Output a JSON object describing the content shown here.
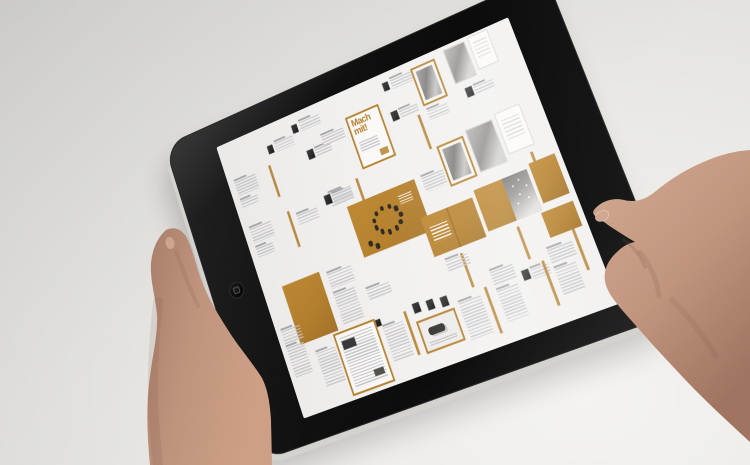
{
  "palette": {
    "background": "#e7e6e3",
    "bezel": "#141414",
    "edge": "#d3d2ce",
    "screen": "#f2f1ef",
    "accent": "#b5812e",
    "ink": "#c7c7ca",
    "thumb": "#2b2b2d",
    "skin": "#c59b85",
    "skin-shadow": "#9c7361",
    "nail": "#d0a892"
  },
  "device": {
    "home_button_glyph": "rounded-square"
  },
  "screen_content": {
    "cover_title": "Mach mit!",
    "tiles": [
      {
        "t": "tx",
        "x": 8,
        "y": 44,
        "w": 28,
        "h": 16
      },
      {
        "t": "tx",
        "x": 8,
        "y": 66,
        "w": 22,
        "h": 9
      },
      {
        "t": "ln",
        "x": 54,
        "y": 42,
        "w": 3,
        "h": 36
      },
      {
        "t": "th",
        "x": 60,
        "y": 22,
        "w": 7,
        "h": 9
      },
      {
        "t": "tx",
        "x": 70,
        "y": 22,
        "w": 24,
        "h": 10
      },
      {
        "t": "th",
        "x": 96,
        "y": 12,
        "w": 7,
        "h": 9
      },
      {
        "t": "tx",
        "x": 106,
        "y": 12,
        "w": 26,
        "h": 10
      },
      {
        "t": "th",
        "x": 104,
        "y": 44,
        "w": 8,
        "h": 10
      },
      {
        "t": "tx",
        "x": 114,
        "y": 46,
        "w": 20,
        "h": 8
      },
      {
        "t": "tx",
        "x": 126,
        "y": 36,
        "w": 28,
        "h": 12
      },
      {
        "t": "mm",
        "x": 160,
        "y": 28,
        "w": 42,
        "h": 58
      },
      {
        "t": "ln",
        "x": 148,
        "y": 92,
        "w": 3,
        "h": 36
      },
      {
        "t": "tx",
        "x": 112,
        "y": 96,
        "w": 28,
        "h": 14
      },
      {
        "t": "th",
        "x": 214,
        "y": 10,
        "w": 7,
        "h": 9
      },
      {
        "t": "tx",
        "x": 224,
        "y": 10,
        "w": 26,
        "h": 10
      },
      {
        "t": "th",
        "x": 212,
        "y": 42,
        "w": 8,
        "h": 10
      },
      {
        "t": "tx",
        "x": 222,
        "y": 44,
        "w": 22,
        "h": 8
      },
      {
        "t": "fp",
        "x": 250,
        "y": 8,
        "w": 30,
        "h": 42
      },
      {
        "t": "ln",
        "x": 240,
        "y": 56,
        "w": 3,
        "h": 38
      },
      {
        "t": "tx",
        "x": 252,
        "y": 56,
        "w": 24,
        "h": 10
      },
      {
        "t": "pp",
        "x": 292,
        "y": 4,
        "w": 26,
        "h": 38
      },
      {
        "t": "wp",
        "x": 322,
        "y": 2,
        "w": 24,
        "h": 36
      },
      {
        "t": "th",
        "x": 300,
        "y": 50,
        "w": 8,
        "h": 10
      },
      {
        "t": "tx",
        "x": 310,
        "y": 52,
        "w": 22,
        "h": 9
      },
      {
        "t": "tx",
        "x": 8,
        "y": 98,
        "w": 28,
        "h": 16
      },
      {
        "t": "tx",
        "x": 8,
        "y": 120,
        "w": 22,
        "h": 10
      },
      {
        "t": "ln",
        "x": 58,
        "y": 96,
        "w": 3,
        "h": 40
      },
      {
        "t": "tx",
        "x": 68,
        "y": 104,
        "w": 26,
        "h": 12
      },
      {
        "t": "th",
        "x": 106,
        "y": 96,
        "w": 8,
        "h": 10
      },
      {
        "t": "tx",
        "x": 116,
        "y": 98,
        "w": 24,
        "h": 10
      },
      {
        "t": "cp",
        "x": 128,
        "y": 116,
        "w": 84,
        "h": 56
      },
      {
        "t": "tx",
        "x": 220,
        "y": 118,
        "w": 26,
        "h": 16
      },
      {
        "t": "fp",
        "x": 248,
        "y": 94,
        "w": 32,
        "h": 44
      },
      {
        "t": "pp",
        "x": 284,
        "y": 90,
        "w": 32,
        "h": 46
      },
      {
        "t": "wp",
        "x": 320,
        "y": 86,
        "w": 30,
        "h": 44
      },
      {
        "t": "ln",
        "x": 342,
        "y": 136,
        "w": 3,
        "h": 36
      },
      {
        "t": "op",
        "x": 24,
        "y": 168,
        "w": 48,
        "h": 64
      },
      {
        "t": "tx",
        "x": 80,
        "y": 174,
        "w": 30,
        "h": 16
      },
      {
        "t": "tx",
        "x": 80,
        "y": 196,
        "w": 26,
        "h": 34
      },
      {
        "t": "th",
        "x": 108,
        "y": 236,
        "w": 14,
        "h": 7
      },
      {
        "t": "tx",
        "x": 118,
        "y": 204,
        "w": 28,
        "h": 12
      },
      {
        "t": "st",
        "x": 204,
        "y": 156,
        "w": 62,
        "h": 42
      },
      {
        "t": "ss",
        "x": 270,
        "y": 150,
        "w": 62,
        "h": 44
      },
      {
        "t": "op",
        "x": 336,
        "y": 146,
        "w": 30,
        "h": 42
      },
      {
        "t": "op",
        "x": 330,
        "y": 196,
        "w": 36,
        "h": 26
      },
      {
        "t": "ln",
        "x": 300,
        "y": 200,
        "w": 3,
        "h": 34
      },
      {
        "t": "ln",
        "x": 232,
        "y": 204,
        "w": 3,
        "h": 36
      },
      {
        "t": "tx",
        "x": 214,
        "y": 206,
        "w": 26,
        "h": 12
      },
      {
        "t": "tx",
        "x": 6,
        "y": 212,
        "w": 24,
        "h": 14
      },
      {
        "t": "tx",
        "x": 6,
        "y": 230,
        "w": 22,
        "h": 32
      },
      {
        "t": "tx",
        "x": 38,
        "y": 246,
        "w": 24,
        "h": 36
      },
      {
        "t": "np",
        "x": 64,
        "y": 234,
        "w": 52,
        "h": 66
      },
      {
        "t": "tx",
        "x": 122,
        "y": 246,
        "w": 24,
        "h": 36
      },
      {
        "t": "ln",
        "x": 150,
        "y": 238,
        "w": 3,
        "h": 46
      },
      {
        "t": "th",
        "x": 162,
        "y": 234,
        "w": 8,
        "h": 10
      },
      {
        "t": "th",
        "x": 178,
        "y": 236,
        "w": 8,
        "h": 10
      },
      {
        "t": "th",
        "x": 194,
        "y": 238,
        "w": 8,
        "h": 10
      },
      {
        "t": "fc",
        "x": 160,
        "y": 252,
        "w": 46,
        "h": 34
      },
      {
        "t": "tx",
        "x": 212,
        "y": 250,
        "w": 26,
        "h": 38
      },
      {
        "t": "ln",
        "x": 244,
        "y": 244,
        "w": 3,
        "h": 48
      },
      {
        "t": "tx",
        "x": 256,
        "y": 232,
        "w": 26,
        "h": 14
      },
      {
        "t": "tx",
        "x": 256,
        "y": 252,
        "w": 24,
        "h": 32
      },
      {
        "t": "th",
        "x": 288,
        "y": 242,
        "w": 8,
        "h": 10
      },
      {
        "t": "tx",
        "x": 298,
        "y": 244,
        "w": 20,
        "h": 10
      },
      {
        "t": "ln",
        "x": 312,
        "y": 240,
        "w": 3,
        "h": 46
      },
      {
        "t": "tx",
        "x": 322,
        "y": 232,
        "w": 28,
        "h": 14
      },
      {
        "t": "tx",
        "x": 322,
        "y": 252,
        "w": 24,
        "h": 28
      },
      {
        "t": "ln",
        "x": 354,
        "y": 222,
        "w": 3,
        "h": 42
      }
    ]
  }
}
